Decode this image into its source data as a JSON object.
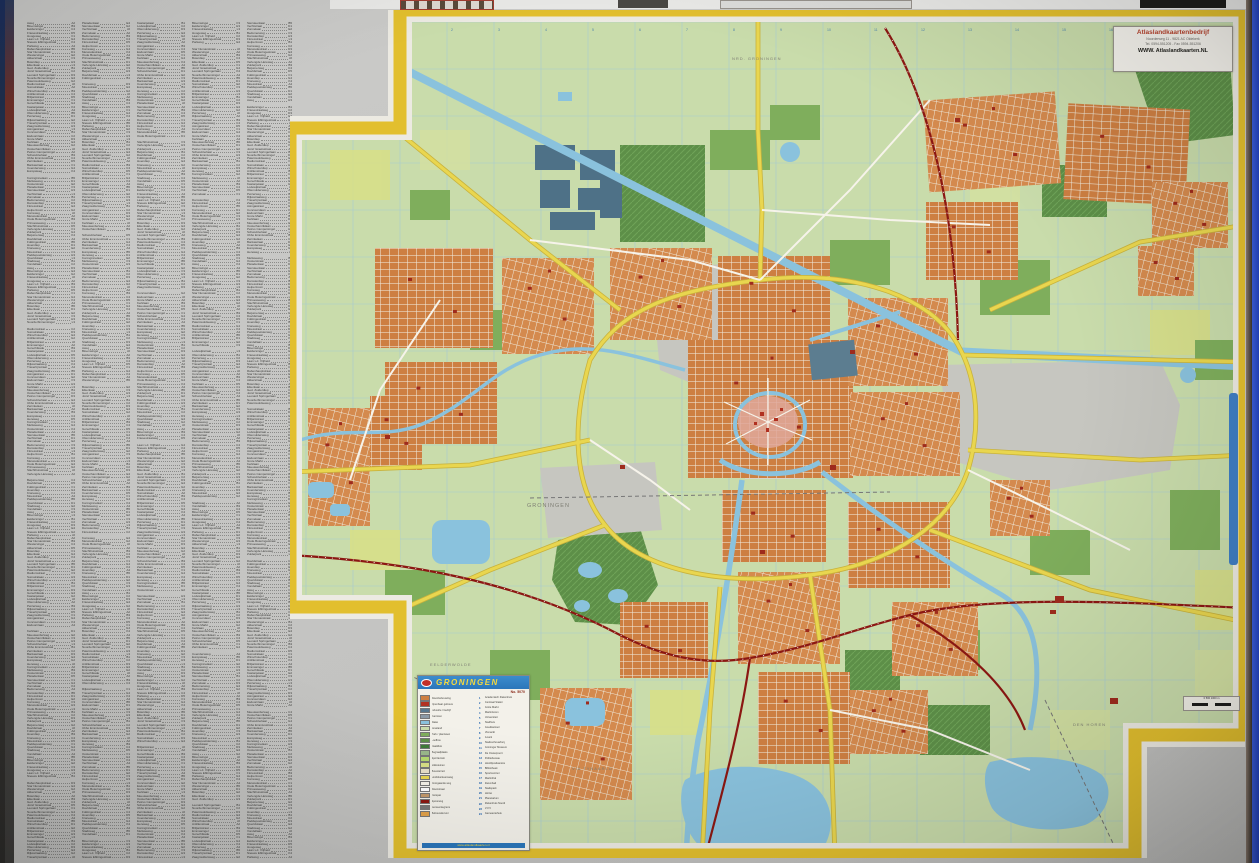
{
  "photo": {
    "background": "#c6c6c4",
    "left_strip_colors": [
      "#1c2f5e",
      "#713028",
      "#3e3d3b"
    ],
    "right_strip_color": "#2b4fd0"
  },
  "street_index": {
    "columns": 5,
    "entries_per_column": 260,
    "streets": [
      "Aweg",
      "Akkerstraat",
      "Antillenstraat",
      "Asingastraat",
      "Bankastraat",
      "Bedumerweg",
      "Beijumerweg",
      "Bloemsingel",
      "Boterdiep",
      "Briljantstraat",
      "Concourslaan",
      "Coendersweg",
      "Damsterdiep",
      "Davidstraat",
      "Eeldersingel",
      "Eikenlaan",
      "Emmasingel",
      "Esdoornlaan",
      "Europaweg",
      "Floresstraat",
      "Folkingestraat",
      "Friesestraatweg",
      "Ged. Zuiderdiep",
      "Gorechtkade",
      "Grote Markt",
      "Hereweg",
      "Helperzoom",
      "Hoendiep",
      "Hoogeweg",
      "Jozef Israelsstraat",
      "Kastanjelaan",
      "Kerklaan",
      "Koninginnelaan",
      "Korreweg",
      "Kraneweg",
      "Laan v.d. Vrijheid",
      "Leonard Springerlaan",
      "Lodewijkstraat",
      "Meeuwerderweg",
      "Melisseweg",
      "Merwedestraat",
      "Moesstraat",
      "Nieuwe Ebbingestraat",
      "Noorderbinnensingel",
      "Oliemuldersweg",
      "Oosterhamriklaan",
      "Oosterstraat",
      "Oude Boteringestraat",
      "Paddepoelsterweg",
      "Parkweg",
      "Paterswoldseweg",
      "Peizerweg",
      "Petrus Campersingel",
      "Pleiadenlaan",
      "Prinsesseweg",
      "Queridolaan",
      "Rabenhauptstraat",
      "Radiumstraat",
      "Rijksstraatweg",
      "Schweitzerlaan",
      "Siersteenlaan",
      "Slachthuisstraat",
      "Stadsweg",
      "Star Numanstraat",
      "Sumatralaan",
      "Travertijnstraat",
      "Ubbo Emmiusstraat",
      "Vechtstraat",
      "Verlengde Hereweg",
      "Vondellaan",
      "Westersingel",
      "Winschoterdiep",
      "Zaagmuldersweg",
      "Zernikelaan",
      "Zonnelaan",
      "Zuiderpark"
    ],
    "grid_refs": [
      "A2",
      "A4",
      "B1",
      "B3",
      "B5",
      "C2",
      "C4",
      "D1",
      "D3",
      "D5",
      "E2",
      "E4",
      "F1",
      "F3",
      "G2",
      "G4",
      "H3",
      "J2",
      "K4",
      "L3"
    ]
  },
  "map_sheet": {
    "region_labels": [
      "NRD. GRONINGEN",
      "GRONINGEN",
      "DEN HOREN",
      "VIA TYNAARLO",
      "EELDERWOLDE"
    ],
    "publisher_box": {
      "line1": "Atlaslandkaartenbedrijf",
      "line2": "Noorderweg 11 - 9821 AC Oldekerk",
      "line3": "Tel. 0594-551205 - Fax 0594-551206",
      "line4": "WWW. Atlaslandkaarten.NL"
    },
    "legend": {
      "title": "GRONINGEN",
      "number": "No. 5070",
      "items": [
        {
          "color": "#cd7f42",
          "label": "Woonbebouwing"
        },
        {
          "color": "#b23222",
          "label": "Openbaar gebouw"
        },
        {
          "color": "#57788e",
          "label": "Industrie / bedrijf"
        },
        {
          "color": "#8b9aa6",
          "label": "Kantoren"
        },
        {
          "color": "#8ac2dd",
          "label": "Water"
        },
        {
          "color": "#c9dcab",
          "label": "Grasland"
        },
        {
          "color": "#7fae5c",
          "label": "Park / plantsoen"
        },
        {
          "color": "#5d8f48",
          "label": "Loofbos"
        },
        {
          "color": "#3f7a38",
          "label": "Naaldbos"
        },
        {
          "color": "#9ab88a",
          "label": "Begraafplaats"
        },
        {
          "color": "#b5d96e",
          "label": "Sportterrein"
        },
        {
          "color": "#d8df86",
          "label": "Volkstuinen"
        },
        {
          "color": "#e8e0c8",
          "label": "Bouwterrein"
        },
        {
          "color": "#e9d64f",
          "label": "Hoofdverkeersweg"
        },
        {
          "color": "#f6f3ea",
          "label": "Doorgaande weg"
        },
        {
          "color": "#ffffff",
          "label": "Woonstraat"
        },
        {
          "color": "#c49a6c",
          "label": "Fietspad"
        },
        {
          "color": "#8b1712",
          "label": "Spoorweg"
        },
        {
          "color": "#777777",
          "label": "Gemeentegrens"
        },
        {
          "color": "#e2a24a",
          "label": "Bebouwde kom"
        }
      ],
      "poi": [
        "Academisch Ziekenhuis",
        "Centraal Station",
        "Grote Markt",
        "Martinitoren",
        "Universiteit",
        "Stadhuis",
        "Goudkantoor",
        "Vismarkt",
        "A-kerk",
        "Stadsschouwburg",
        "Groninger Museum",
        "De Oosterpoort",
        "Politiebureau",
        "Hoofdpostkantoor",
        "Bibliotheek",
        "Sportcentrum",
        "Martinihal",
        "Zwembad",
        "Stadspark",
        "Hortus",
        "Planetarium",
        "Ziekenhuis Noord",
        "V.V.V.",
        "Gemeentehuis"
      ],
      "footer": "www.atlaslandkaarten.nl"
    },
    "scale_bar": {
      "label": "0     500     1000 m"
    },
    "colors": {
      "map_background": "#c9dcab",
      "urban": "#cd7f42",
      "water": "#8ac2dd",
      "industry_gray": "#c6c6c0",
      "industry_slate": "#4e7187",
      "woods": "#5d8f48",
      "main_road": "#e9d64f",
      "railway": "#8b1712",
      "border": "#e2bf2e"
    }
  }
}
